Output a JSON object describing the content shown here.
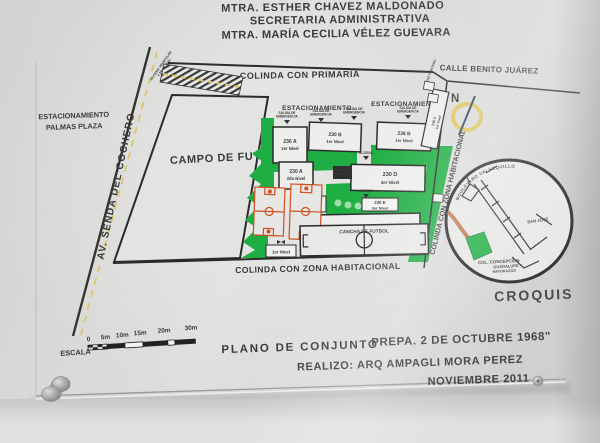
{
  "header": {
    "line1": "MTRA. ESTHER CHAVEZ MALDONADO",
    "line2": "SECRETARIA ADMINISTRATIVA",
    "line3": "MTRA. MARÍA CECILIA VÉLEZ GUEVARA"
  },
  "surroundings": {
    "parking_line1": "ESTACIONAMIENTO",
    "parking_line2": "PALMAS PLAZA",
    "avenue": "AV. SENDA DEL COCHERO",
    "access_nw1": "ACCESO VEHICULAR",
    "access_nw2": "Y PEATONAL",
    "access_ne": "ACCESO PEATONAL",
    "north": "COLINDA CON PRIMARIA",
    "street_ne": "CALLE BENITO JUÁREZ",
    "south": "COLINDA CON ZONA HABITACIONAL",
    "east": "COLINDA CON ZONA HABITACIONAL"
  },
  "map": {
    "field": "CAMPO DE FUTBOL",
    "court": "CANCHA DE FUTBOL",
    "parking1": "ESTACIONAMIENTO",
    "parking2": "ESTACIONAMIENTO",
    "exit_line1": "SALIDA DE",
    "exit_line2": "EMERGENCIA",
    "access": "ACCESO",
    "level_small": "1er Nivel",
    "compass_n": "N",
    "buildings": [
      {
        "id": "236 A",
        "level": "1er Nivel"
      },
      {
        "id": "230 B",
        "level": "1er Nivel"
      },
      {
        "id": "236 B",
        "level": "1er Nivel"
      },
      {
        "id": "230 A",
        "level": "2do Nivel"
      },
      {
        "id": "230 D",
        "level": "3er Nivel"
      },
      {
        "id": "230 E",
        "level": "3er Nivel"
      },
      {
        "id": "230 C",
        "level": "1er Nivel"
      }
    ]
  },
  "croquis": {
    "title": "CROQUIS",
    "boulevard": "BOULEVARD VALSEQUILLO",
    "san_jose": "SAN JOSÉ",
    "col1": "COL. CONCEPCION",
    "col2": "GUADALUPE",
    "col3": "MAYORAZGO"
  },
  "scale": {
    "label": "ESCALA",
    "ticks": [
      "0",
      "5m",
      "10m",
      "15m",
      "20m",
      "30m"
    ]
  },
  "footer": {
    "plan_title": "PLANO DE CONJUNTO",
    "school_name": "PREPA. 2 DE OCTUBRE 1968\"",
    "author": "REALIZO: ARQ AMPAGLI MORA PEREZ",
    "date": "NOVIEMBRE 2011"
  },
  "colors": {
    "accent_blue": "#2b4da0",
    "accent_red": "#c0392b",
    "boundary_orange": "#c8552a",
    "map_green": "#1fae43",
    "court_orange": "#cf4f1f",
    "croquis_red": "#cf5535",
    "compass_yellow": "#dfc153"
  }
}
